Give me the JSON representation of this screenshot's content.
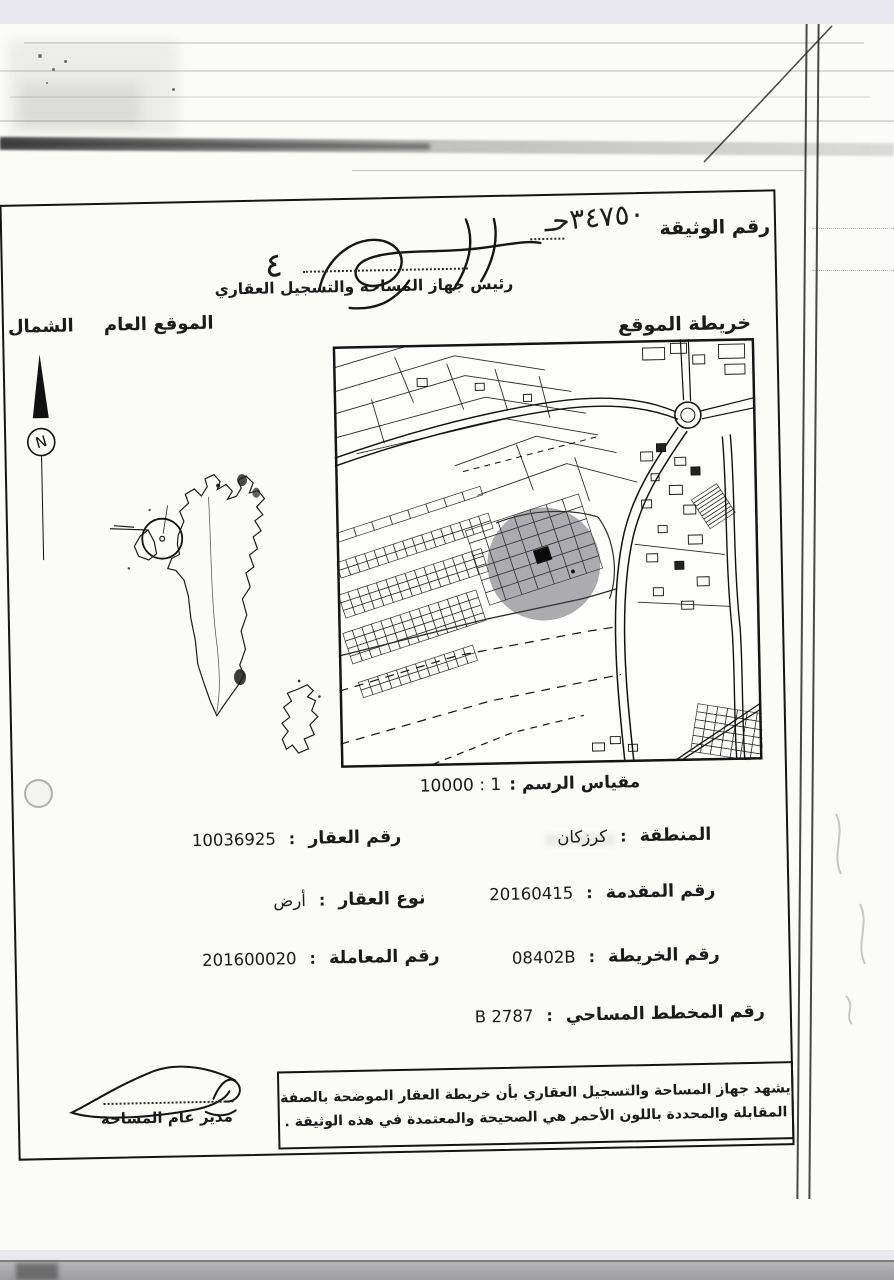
{
  "header": {
    "doc_number_label": "رقم الوثيقة",
    "doc_number_value": "٣٤٧٥٠حـ",
    "signature_mark": "٤",
    "signatory_title": "رئيس جهاز المساحة والتسجيل العقاري"
  },
  "map_section": {
    "north_label": "الشمال",
    "compass_letter": "N",
    "general_location_label": "الموقع العام",
    "site_map_label": "خريطة الموقع",
    "scale_label": "مقياس الرسم :",
    "scale_value": "1 : 10000"
  },
  "fields": {
    "separator": ":",
    "right": [
      {
        "label": "المنطقة",
        "value": "كرزكان"
      },
      {
        "label": "رقم المقدمة",
        "value": "20160415"
      },
      {
        "label": "رقم الخريطة",
        "value": "08402B"
      },
      {
        "label": "رقم المخطط المساحي",
        "value": "2787 B"
      }
    ],
    "left": [
      {
        "label": "رقم العقار",
        "value": "10036925"
      },
      {
        "label": "نوع العقار",
        "value": "أرض"
      },
      {
        "label": "رقم المعاملة",
        "value": "201600020"
      }
    ]
  },
  "footer": {
    "certification_line1": "يشهد جهاز المساحة والتسجيل العقاري بأن خريطة العقار الموضحة بالصفة",
    "certification_line2": "المقابلة والمحددة باللون الأحمر هي الصحيحة والمعتمدة في هذه الوثيقة .",
    "director_title": "مدير عام المساحة"
  },
  "colors": {
    "ink": "#1a1a1a",
    "paper": "#fbfbf8",
    "zone_gray": "#3f3f4a",
    "background": "#e8e8ee"
  }
}
